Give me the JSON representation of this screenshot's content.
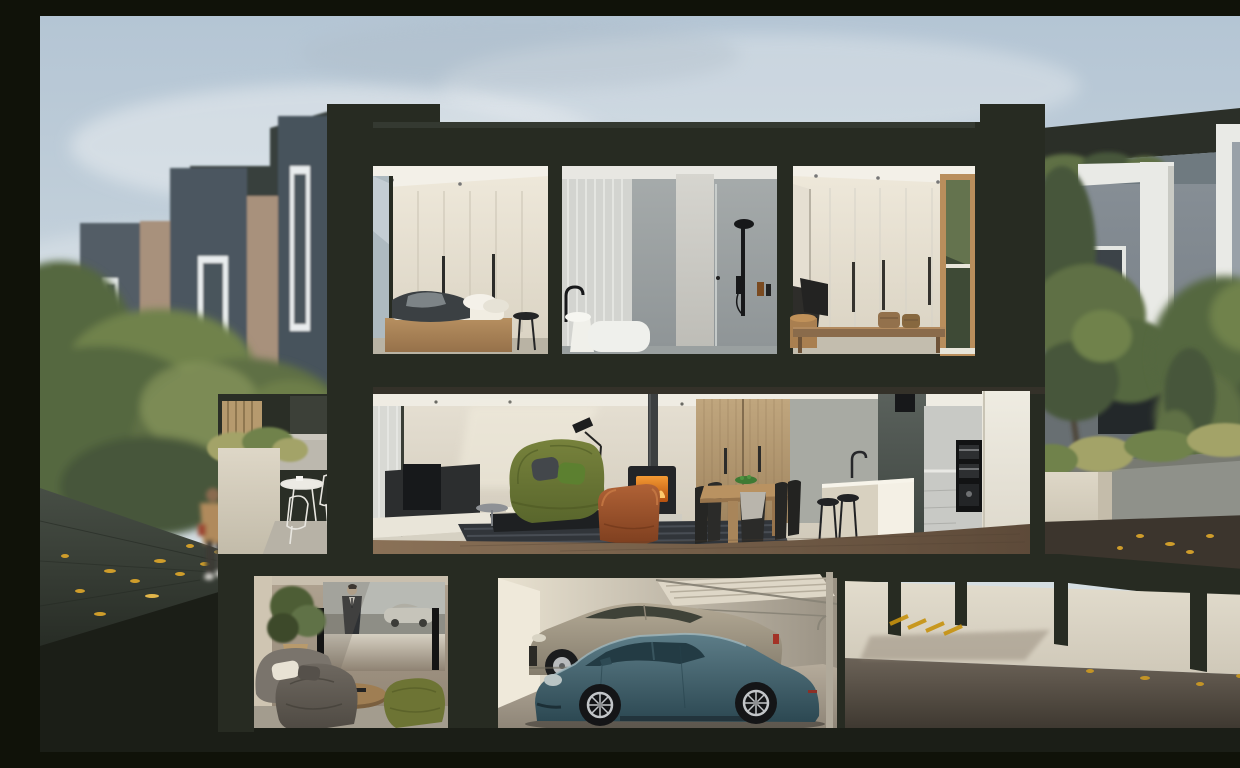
{
  "meta": {
    "title": "Townhouse cross-section render",
    "description": "Photorealistic dusk cross-section render of a three-storey townhouse: basement home cinema and two-car garage with a shared driveway, mid-level open-plan living, dining and kitchen, upper-level bedrooms and bathroom, flanked by rows of charcoal townhouses, trees, a terrace and a pedestrian path."
  },
  "palette": {
    "skyTop": "#b4c5d4",
    "skyMid": "#cdd8df",
    "skyBot": "#dde3e6",
    "cloud": "#e9edf0",
    "charcoal": "#272b22",
    "charcoalLt": "#343931",
    "charcoalDk": "#1b1e17",
    "bgFaceA": "#46525c",
    "bgFaceB": "#4b5660",
    "bgFaceC": "#525d66",
    "bgFin": "#a8917b",
    "bgFin2": "#9c8772",
    "bgMass": "#39413c",
    "winWhite": "#e9edee",
    "winGlass": "#4a545c",
    "treeA": "#55673f",
    "treeB": "#5e7044",
    "treeC": "#47563a",
    "treeD": "#70824c",
    "treeHi": "#87975d",
    "pathTop": "#474e45",
    "pathBot": "#272c25",
    "leaf": "#cf9d2b",
    "leafHi": "#e2b64a",
    "personCoat": "#b08a5c",
    "personDark": "#3e3a36",
    "personHead": "#8a6b50",
    "personShoe": "#d9d7d2",
    "personBag": "#9c4632",
    "stone": "#ded7c7",
    "stoneDk": "#c2bba9",
    "benchGrey": "#bcb8ae",
    "fenceTan": "#b69a6e",
    "rbRoof": "#2b2f28",
    "rbGlass": "#6f7a80",
    "rbFaceTop": "#868e95",
    "rbFaceBot": "#6d757c",
    "rbFrame": "#e9eae6",
    "rbInner": "#99a1a8",
    "rbWin": "#3c4348",
    "courtWall": "#686f72",
    "courtOpen": "#23282a",
    "planter": "#8f918a",
    "planterDk": "#787a72",
    "grass": "#a3a368",
    "groundDk": "#3c352d",
    "creamTop": "#efe9db",
    "creamBot": "#d9d2c2",
    "ceilWhite": "#f3f0e8",
    "handle": "#2c2c2a",
    "wardLine": "#c9c2b2",
    "timberHi": "#b68f60",
    "timberLo": "#96714a",
    "bedWhite": "#f1ede2",
    "throwDk": "#3b4043",
    "throwLt": "#7d8487",
    "tileTop": "#a7acac",
    "tileBot": "#8e9496",
    "curtain": "#d3d4d0",
    "curtainHi": "#e9eae6",
    "tubWhite": "#eff0ec",
    "blackFix": "#17181a",
    "partTop": "#d6d5cf",
    "partBot": "#bdbcb6",
    "bottleAmber": "#7a4a20",
    "deskWood": "#8a6b4b",
    "basket": "#93714c",
    "drumWood": "#a97f50",
    "revealTimber": "#b98e5c",
    "gardenHi": "#6b7a52",
    "gardenLo": "#3e4a36",
    "wallMidTop": "#e6e0d3",
    "wallMidBot": "#cfc8b8",
    "recessTop": "#5a615c",
    "recessBot": "#3f4641",
    "panelTop": "#c0a67e",
    "panelBot": "#a0855f",
    "greyWall": "#a8aaa3",
    "sofaTop": "#77823c",
    "sofaBot": "#59662c",
    "cushGrey": "#43474b",
    "cushGreen": "#5c8030",
    "leatherHi": "#b06236",
    "leatherLo": "#7e3f1f",
    "rug": "#31353a",
    "rugHi": "#555b62",
    "tvDark": "#2c2e2f",
    "plinth": "#e9e5d9",
    "fireHi": "#f49a33",
    "fireLo": "#b5500f",
    "flame": "#ffc96b",
    "hearth": "#cfccc2",
    "tableWood": "#b99261",
    "tableEdge": "#97744c",
    "chairBlk": "#262624",
    "bowlGreen": "#3f7a34",
    "thrGrey": "#b9b5ac",
    "islandHi": "#f4f0e5",
    "islandLo": "#d8d1c0",
    "cabGrey": "#c8c9c5",
    "pillarHi": "#efece2",
    "pillarLo": "#ddd8cb",
    "applianceBlk": "#121314",
    "floorHi": "#8a7157",
    "floorLo": "#5d4a39",
    "thWallHi": "#b0a391",
    "thWallLo": "#8e8272",
    "thWallLt": "#cfc5b2",
    "scrSky": "#b8bab4",
    "scrRoad": "#8e8e86",
    "scrSuit": "#2e3134",
    "scrCar": "#c6c4ba",
    "scrGlow": "#d6d0c2",
    "spkBlk": "#141414",
    "beanHi": "#6e6860",
    "beanLo": "#4e4942",
    "pillowCream": "#e8e2d4",
    "ottoGreen": "#6d7434",
    "roundWood": "#9f7e53",
    "thFloor": "#a39c8e",
    "gWallHi": "#e9e2d1",
    "gWallLo": "#9a9284",
    "gWallLt": "#efe9da",
    "gFloorHi": "#b5ab9b",
    "gFloorLo": "#8f8678",
    "doorSlat": "#ded7c7",
    "trackGrey": "#8a8578",
    "bentleyHi": "#b3a995",
    "bentleyLo": "#857d6d",
    "bentleyGlass": "#3f4238",
    "tailRed": "#a33226",
    "porscheHi": "#5d7d88",
    "porscheLo": "#2c4852",
    "porscheGlass": "#233b44",
    "porscheLight": "#b9c4c4",
    "rimSilver": "#c3c6c9",
    "tyreBlk": "#141517",
    "dWallHi": "#e2dccd",
    "dWallLo": "#cfc8b8",
    "dFloorHi": "#6b6257",
    "dFloorLo": "#3f3931",
    "markYellow": "#c7920e"
  },
  "scene": {
    "setting": "dusk, autumn leaves, blurred pedestrian on timber path",
    "levels": [
      {
        "name": "upper floor",
        "rooms": [
          {
            "name": "main bedroom",
            "items": [
              "cream wardrobe wall",
              "timber platform bed",
              "grey throw and pillows",
              "black round side table"
            ]
          },
          {
            "name": "bathroom",
            "items": [
              "sheer curtain",
              "freestanding white bath",
              "black arch tapware",
              "stone partition",
              "black rail shower",
              "amber bottle shelf"
            ]
          },
          {
            "name": "second bedroom",
            "items": [
              "white wardrobe wall",
              "timber desk with wicker baskets",
              "timber-framed garden window"
            ]
          }
        ]
      },
      {
        "name": "living level",
        "rooms": [
          {
            "name": "living room",
            "items": [
              "sheer curtain window",
              "dark tv joinery on white plinth",
              "green fabric sofa",
              "tan leather armchair",
              "black coffee table with books",
              "striped rug",
              "freestanding black fireplace with flue",
              "black floor lamp"
            ]
          },
          {
            "name": "dining",
            "items": [
              "timber joinery wall with two doors",
              "timber pedestal table",
              "black dining chairs",
              "green fruit bowl"
            ]
          },
          {
            "name": "kitchen",
            "items": [
              "stone island with waterfall end",
              "black tapware",
              "two black bar stools",
              "integrated black ovens and coffee machine",
              "tall white joinery tower",
              "black pendant box"
            ]
          },
          {
            "name": "terrace (left)",
            "items": [
              "timber battens",
              "stone planter with grasses",
              "white wire table and chairs",
              "concrete bench"
            ]
          }
        ]
      },
      {
        "name": "basement",
        "rooms": [
          {
            "name": "home cinema",
            "items": [
              "projection screen playing a film of a man in a dark suit beside a silver sports car",
              "two black floor speakers",
              "potted plant",
              "round timber coffee table",
              "grey slouch lounges",
              "cream cushion",
              "olive green ottoman"
            ]
          },
          {
            "name": "garage",
            "items": [
              "teal sports coupe",
              "champagne luxury coupe",
              "open tilt-up slatted garage door"
            ]
          },
          {
            "name": "shared driveway",
            "items": [
              "concrete columns",
              "yellow pavement markings",
              "scattered leaves"
            ]
          }
        ]
      }
    ],
    "exterior": {
      "left": "receding row of charcoal townhouses with tan concrete fins and slot windows, mature trees, timber path with fallen leaves and a pedestrian",
      "right": "neighbouring grey buildings with white picture-frame windows, rooftop planting, courtyard tree, concrete planters with grasses, white stone plinths"
    }
  }
}
